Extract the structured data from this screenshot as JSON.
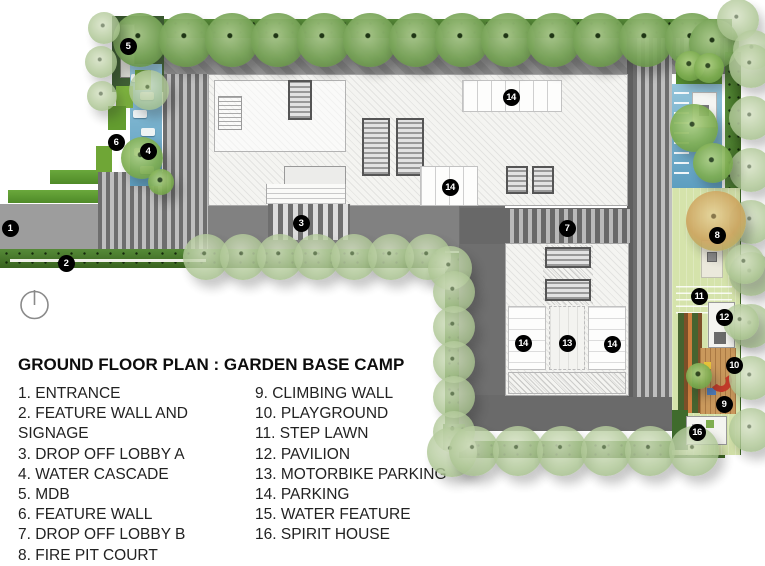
{
  "legend": {
    "title": "GROUND FLOOR PLAN : GARDEN BASE CAMP",
    "north_icon": "north-arrow-icon",
    "columns": [
      [
        "1. ENTRANCE",
        "2. FEATURE WALL AND SIGNAGE",
        "3. DROP OFF LOBBY A",
        "4. WATER CASCADE",
        "5. MDB",
        "6. FEATURE WALL",
        "7. DROP OFF LOBBY B",
        "8. FIRE PIT COURT"
      ],
      [
        "9. CLIMBING WALL",
        "10. PLAYGROUND",
        "11. STEP LAWN",
        "12. PAVILION",
        "13. MOTORBIKE PARKING",
        "14. PARKING",
        "15. WATER FEATURE",
        "16. SPIRIT HOUSE"
      ]
    ]
  },
  "plan": {
    "markers": [
      {
        "n": "1",
        "x": 10,
        "y": 228
      },
      {
        "n": "2",
        "x": 66,
        "y": 263
      },
      {
        "n": "3",
        "x": 301,
        "y": 223
      },
      {
        "n": "4",
        "x": 148,
        "y": 151
      },
      {
        "n": "5",
        "x": 128,
        "y": 46
      },
      {
        "n": "6",
        "x": 116,
        "y": 142
      },
      {
        "n": "7",
        "x": 567,
        "y": 228
      },
      {
        "n": "8",
        "x": 717,
        "y": 235
      },
      {
        "n": "9",
        "x": 724,
        "y": 404
      },
      {
        "n": "10",
        "x": 734,
        "y": 365
      },
      {
        "n": "11",
        "x": 699,
        "y": 296
      },
      {
        "n": "12",
        "x": 724,
        "y": 317
      },
      {
        "n": "13",
        "x": 567,
        "y": 343
      },
      {
        "n": "14",
        "x": 511,
        "y": 97
      },
      {
        "n": "14",
        "x": 450,
        "y": 187
      },
      {
        "n": "14",
        "x": 523,
        "y": 343
      },
      {
        "n": "14",
        "x": 612,
        "y": 344
      },
      {
        "n": "16",
        "x": 697,
        "y": 432
      }
    ],
    "colors": {
      "marker_bg": "#000000",
      "marker_text": "#ffffff",
      "hedge_green": "#44702f",
      "tree_green": "#7aa65a",
      "lawn_green": "#d5e3ab",
      "water_blue": "#74aecc",
      "road_gray": "#8d8d8d",
      "building_white": "#f4f4f1",
      "playground_wood": "#c9985c",
      "climbing_wall_red": "#c23b2a"
    }
  }
}
